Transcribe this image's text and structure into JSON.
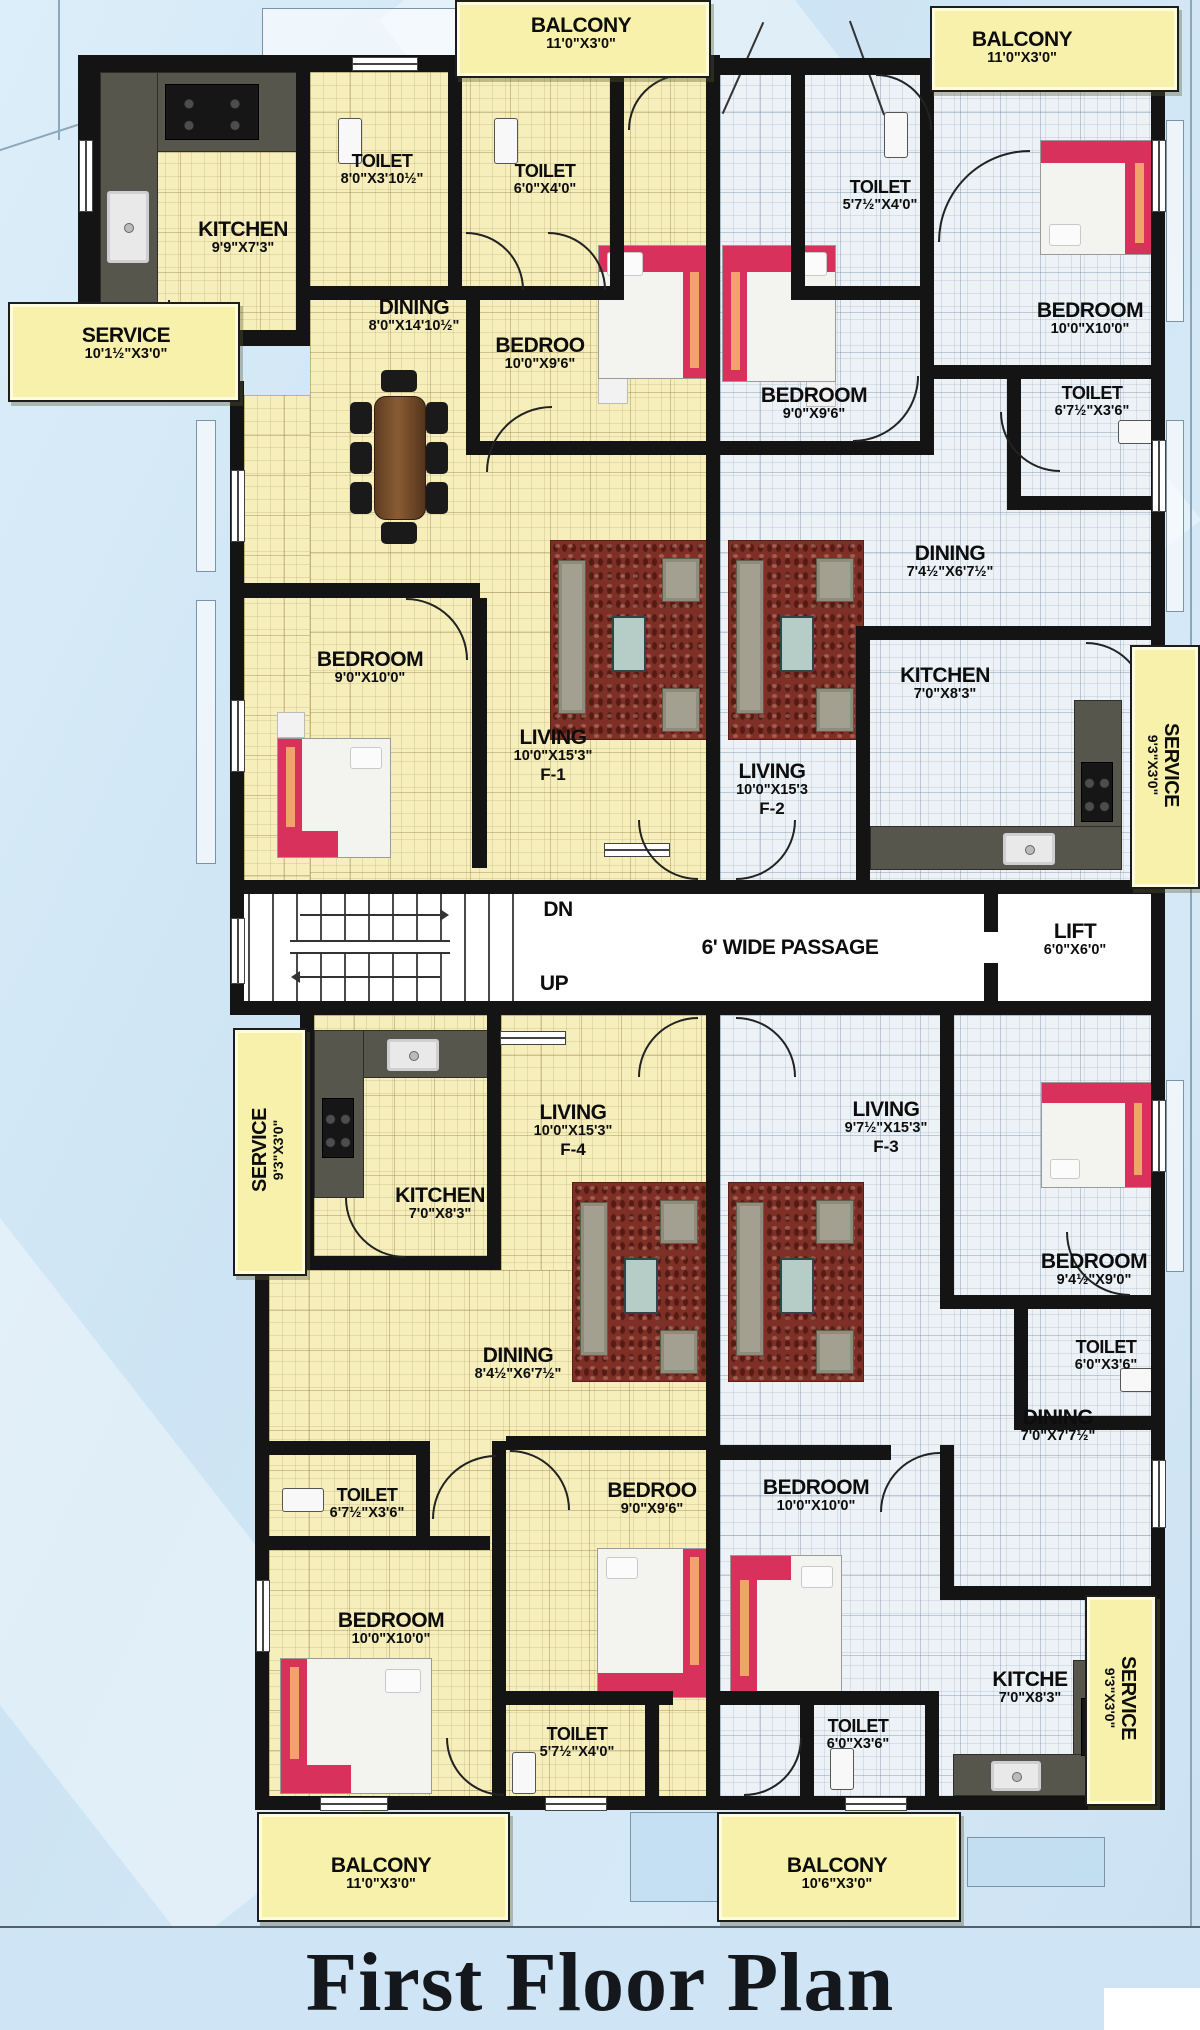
{
  "title": "First Floor Plan",
  "core": {
    "down_label": "DN",
    "up_label": "UP",
    "passage_label": "6' WIDE PASSAGE",
    "lift": {
      "name": "LIFT",
      "dims": "6'0\"X6'0\""
    }
  },
  "rooms": {
    "balcony_tl": {
      "name": "BALCONY",
      "dims": "11'0\"X3'0\""
    },
    "balcony_tr": {
      "name": "BALCONY",
      "dims": "11'0\"X3'0\""
    },
    "f1_kitchen": {
      "name": "KITCHEN",
      "dims": "9'9\"X7'3\""
    },
    "f1_toilet_a": {
      "name": "TOILET",
      "dims": "8'0\"X3'10½\""
    },
    "f1_toilet_b": {
      "name": "TOILET",
      "dims": "6'0\"X4'0\""
    },
    "f1_service": {
      "name": "SERVICE",
      "dims": "10'1½\"X3'0\""
    },
    "f1_dining": {
      "name": "DINING",
      "dims": "8'0\"X14'10½\""
    },
    "f1_bedroom_a": {
      "name": "BEDROO",
      "dims": "10'0\"X9'6\""
    },
    "f1_bedroom_b": {
      "name": "BEDROOM",
      "dims": "9'0\"X10'0\""
    },
    "f1_living": {
      "name": "LIVING",
      "dims": "10'0\"X15'3\"",
      "flat": "F-1"
    },
    "f2_toilet_a": {
      "name": "TOILET",
      "dims": "5'7½\"X4'0\""
    },
    "f2_bedroom_a": {
      "name": "BEDROOM",
      "dims": "9'0\"X9'6\""
    },
    "f2_bedroom_b": {
      "name": "BEDROOM",
      "dims": "10'0\"X10'0\""
    },
    "f2_toilet_b": {
      "name": "TOILET",
      "dims": "6'7½\"X3'6\""
    },
    "f2_dining": {
      "name": "DINING",
      "dims": "7'4½\"X6'7½\""
    },
    "f2_kitchen": {
      "name": "KITCHEN",
      "dims": "7'0\"X8'3\""
    },
    "f2_service": {
      "name": "SERVICE",
      "dims": "9'3\"X3'0\""
    },
    "f2_living": {
      "name": "LIVING",
      "dims": "10'0\"X15'3",
      "flat": "F-2"
    },
    "f4_service": {
      "name": "SERVICE",
      "dims": "9'3\"X3'0\""
    },
    "f4_kitchen": {
      "name": "KITCHEN",
      "dims": "7'0\"X8'3\""
    },
    "f4_living": {
      "name": "LIVING",
      "dims": "10'0\"X15'3\"",
      "flat": "F-4"
    },
    "f4_dining": {
      "name": "DINING",
      "dims": "8'4½\"X6'7½\""
    },
    "f4_toilet_a": {
      "name": "TOILET",
      "dims": "6'7½\"X3'6\""
    },
    "f4_bedroom_a": {
      "name": "BEDROOM",
      "dims": "10'0\"X10'0\""
    },
    "f4_bedroom_b": {
      "name": "BEDROO",
      "dims": "9'0\"X9'6\""
    },
    "f4_toilet_b": {
      "name": "TOILET",
      "dims": "5'7½\"X4'0\""
    },
    "f3_living": {
      "name": "LIVING",
      "dims": "9'7½\"X15'3\"",
      "flat": "F-3"
    },
    "f3_bedroom_a": {
      "name": "BEDROOM",
      "dims": "9'4½\"X9'0\""
    },
    "f3_toilet_a": {
      "name": "TOILET",
      "dims": "6'0\"X3'6\""
    },
    "f3_dining": {
      "name": "DINING",
      "dims": "7'0\"X7'7½\""
    },
    "f3_bedroom_b": {
      "name": "BEDROOM",
      "dims": "10'0\"X10'0\""
    },
    "f3_kitchen": {
      "name": "KITCHE",
      "dims": "7'0\"X8'3\""
    },
    "f3_service": {
      "name": "SERVICE",
      "dims": "9'3\"X3'0\""
    },
    "f3_toilet_b": {
      "name": "TOILET",
      "dims": "6'0\"X3'6\""
    },
    "balcony_bl": {
      "name": "BALCONY",
      "dims": "11'0\"X3'0\""
    },
    "balcony_br": {
      "name": "BALCONY",
      "dims": "10'6\"X3'0\""
    }
  }
}
